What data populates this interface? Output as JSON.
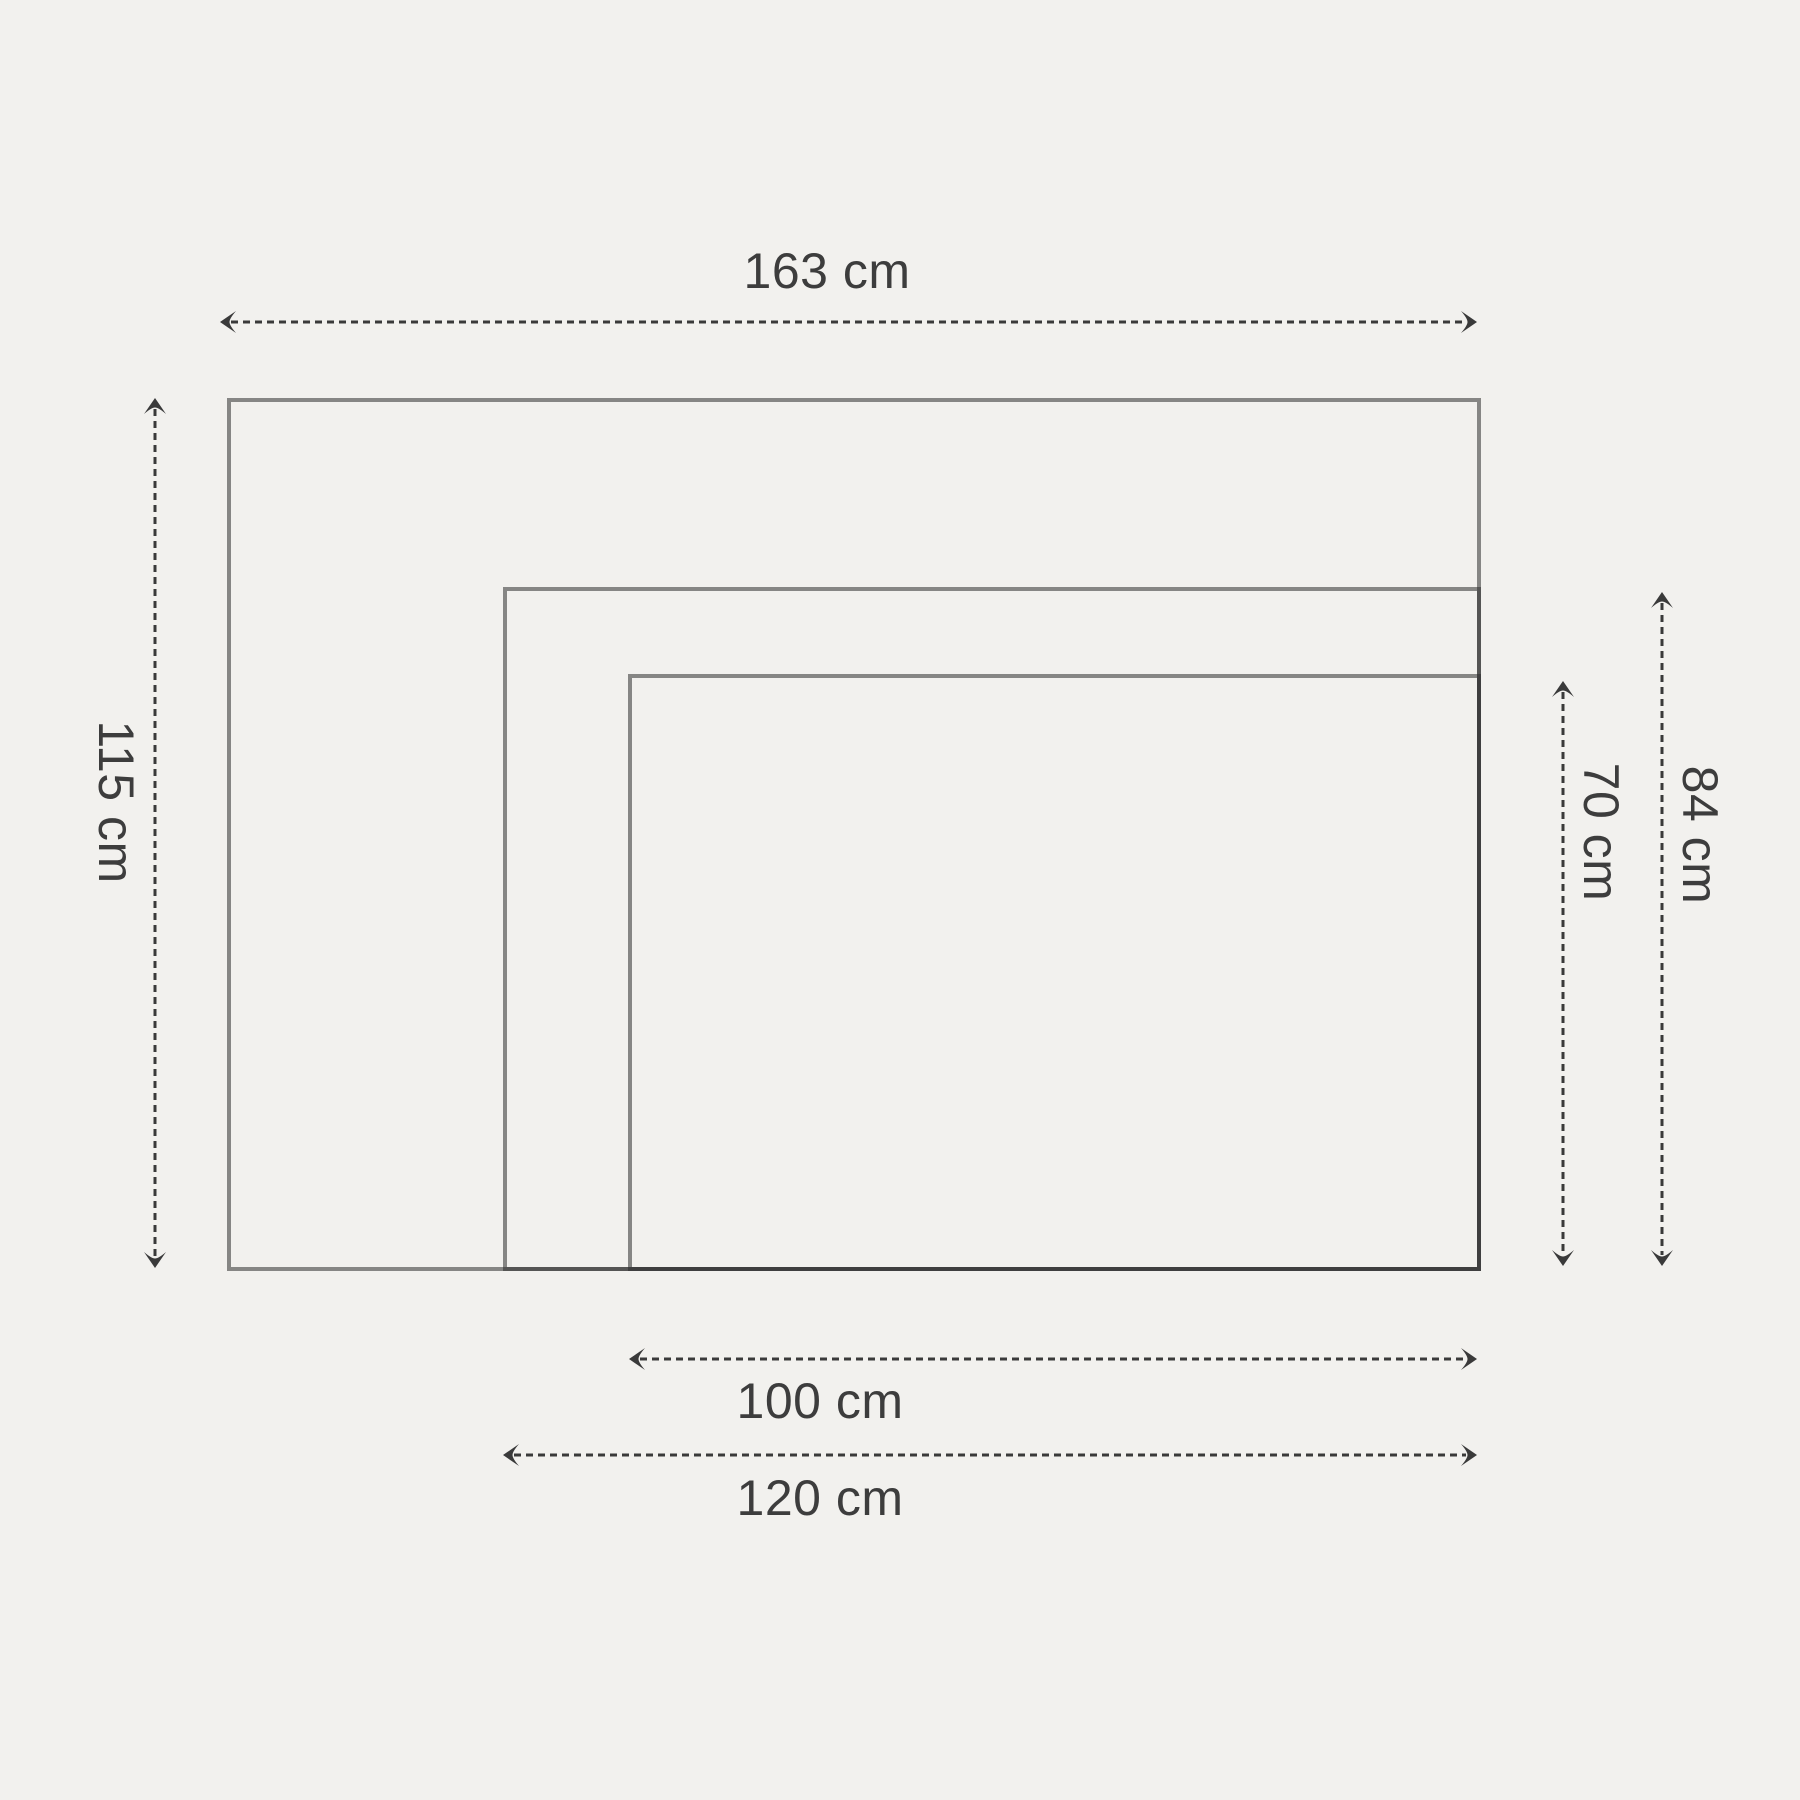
{
  "diagram": {
    "title": "",
    "background_color": "#f2f1ee",
    "rect_stroke_color": "rgba(45,45,45,0.55)",
    "arrow_color": "#3a3a3a",
    "label_color": "#3d3d3d",
    "rectangles": [
      {
        "name": "outer",
        "width_cm": 163,
        "height_cm": 115
      },
      {
        "name": "middle",
        "width_cm": 120,
        "height_cm": 84
      },
      {
        "name": "inner",
        "width_cm": 100,
        "height_cm": 70
      }
    ],
    "labels": {
      "outer_width": "163 cm",
      "outer_height": "115 cm",
      "inner_height": "70 cm",
      "middle_height": "84 cm",
      "inner_width": "100 cm",
      "middle_width": "120 cm"
    }
  }
}
